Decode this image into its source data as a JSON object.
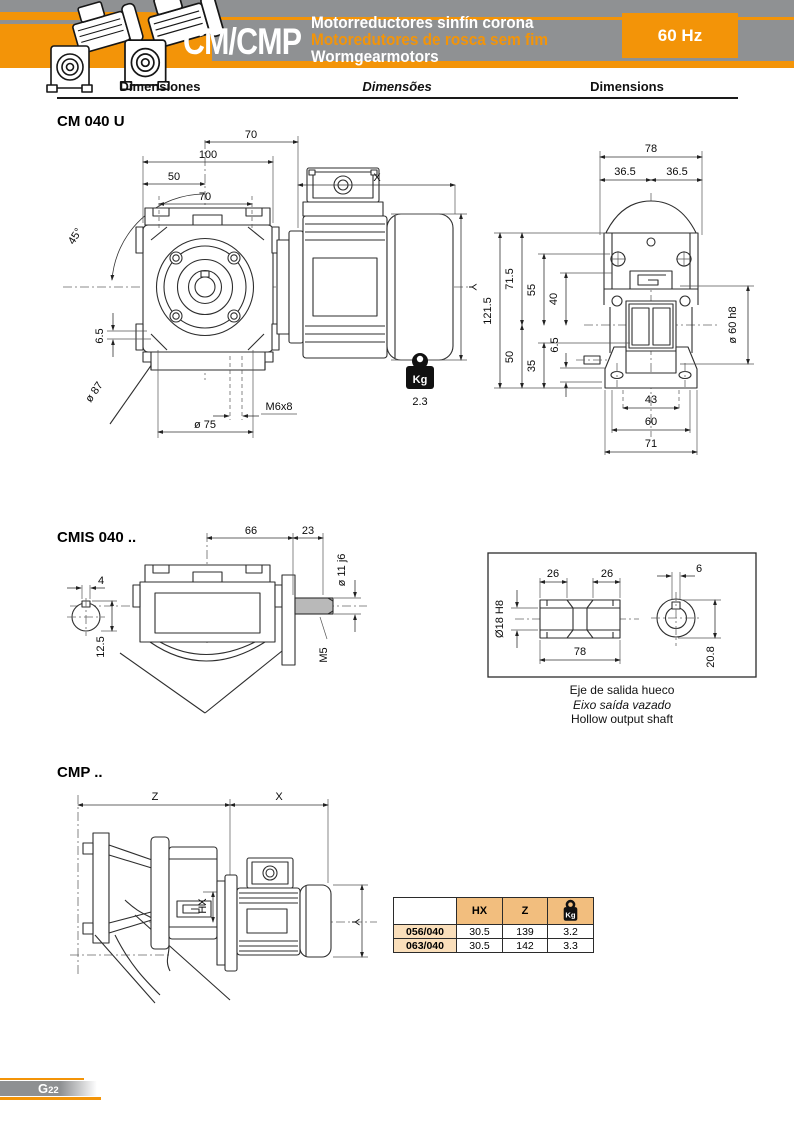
{
  "header": {
    "product_code": "CM/CMP",
    "subtitle_line1": "Motorreductores sinfín corona",
    "subtitle_line2": "Motoredutores de rosca sem fim",
    "subtitle_line3": "Wormgearmotors",
    "frequency_badge": "60 Hz"
  },
  "colors": {
    "orange": "#F39408",
    "band_gray": "#8F9193",
    "table_header_bg": "#F2BE7E",
    "table_row_bg": "#FADFBB"
  },
  "column_headers": {
    "es": "Dimensiones",
    "pt": "Dimensões",
    "en": "Dimensions"
  },
  "cm040u": {
    "title": "CM 040 U",
    "front": {
      "top70": "70",
      "w100": "100",
      "w50": "50",
      "holes70": "70",
      "motor_x": "X",
      "angle45": "45°",
      "offset65": "6.5",
      "bolt_circle": "ø 87",
      "flange": "ø 75",
      "tap": "M6x8",
      "motor_y": "Y"
    },
    "weight": {
      "unit": "Kg",
      "value": "2.3"
    },
    "rear": {
      "w78": "78",
      "w365l": "36.5",
      "w365r": "36.5",
      "h1215": "121.5",
      "h715": "71.5",
      "h55": "55",
      "h40": "40",
      "h50": "50",
      "h35": "35",
      "h65": "6.5",
      "spigot": "ø 60 h8",
      "w43": "43",
      "w60": "60",
      "w71": "71"
    }
  },
  "cmis040": {
    "title": "CMIS 040 ..",
    "side": {
      "l66": "66",
      "l23": "23",
      "key4": "4",
      "h125": "12.5",
      "shaft": "ø 11 j6",
      "tap": "M5"
    },
    "hollow": {
      "l26a": "26",
      "l26b": "26",
      "key6": "6",
      "bore": "Ø18 H8",
      "l78": "78",
      "h208": "20.8"
    },
    "captions": {
      "es": "Eje de salida hueco",
      "pt": "Eixo saída vazado",
      "en": "Hollow output shaft"
    }
  },
  "cmp": {
    "title": "CMP ..",
    "drawing": {
      "z": "Z",
      "x": "X",
      "hx": "HX",
      "y": "Y"
    },
    "table": {
      "col_model": "",
      "col_hx": "HX",
      "col_z": "Z",
      "col_kg": "Kg",
      "rows": [
        {
          "model": "056/040",
          "hx": "30.5",
          "z": "139",
          "kg": "3.2"
        },
        {
          "model": "063/040",
          "hx": "30.5",
          "z": "142",
          "kg": "3.3"
        }
      ]
    }
  },
  "footer": {
    "page_letter": "G",
    "page_number": "22"
  }
}
